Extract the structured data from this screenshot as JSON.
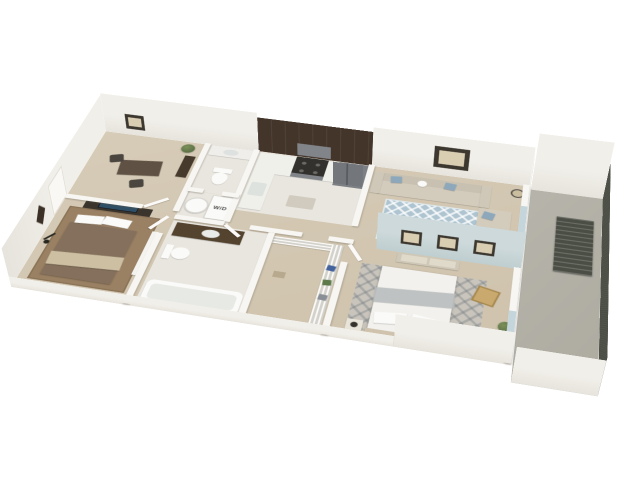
{
  "image": {
    "type": "3d-floorplan-render",
    "description": "Isometric 3D render of a two-bedroom, two-bathroom apartment floor plan with kitchen, living room, dining den, laundry closet, walk-in closet and a long side balcony"
  },
  "labels": {
    "washer_dryer": "W/D"
  },
  "colors": {
    "background": "#ffffff",
    "wall_face": "#f1efe9",
    "wall_top": "#f7f6f2",
    "accent_wall": "#cdd9da",
    "floor_carpet": "#d7ccb8",
    "floor_tile": "#e9e6df",
    "balcony_floor": "#b7b5ab",
    "railing": "#4b4e45",
    "cabinet_wood": "#43352a",
    "counter": "#eff0ea",
    "stainless": "#81858a",
    "sofa": "#d3ccbd",
    "pillow_blue": "#8da8bb",
    "rug_blue": "#aec4d0",
    "rug_gray": "#c9c5bd",
    "bed_white": "#f2f1ed",
    "bed_brown": "#84705c",
    "wood_light": "#d9cbb0",
    "table_wood": "#6b5949",
    "plant_green": "#5e7247",
    "frame_dark": "#3c372f",
    "tv_screen": "#2f4f66",
    "fixture_white": "#fafaf8",
    "glass": "#bdd2d9"
  },
  "rooms": [
    {
      "id": "dining-den",
      "name": "Dining / Den",
      "furniture": [
        "desk",
        "two chairs",
        "potted plant",
        "bookshelf",
        "wall art"
      ]
    },
    {
      "id": "kitchen",
      "name": "Kitchen",
      "furniture": [
        "upper cabinets",
        "L-counter",
        "range",
        "range hood",
        "refrigerator",
        "sink"
      ]
    },
    {
      "id": "living-room",
      "name": "Living Room",
      "furniture": [
        "sectional sofa",
        "blue pillows",
        "patterned area rug",
        "coffee table",
        "floor lamp",
        "wall art",
        "sliding balcony door"
      ]
    },
    {
      "id": "bathroom-1",
      "name": "Bathroom 1",
      "furniture": [
        "sink counter",
        "toilet"
      ]
    },
    {
      "id": "laundry-closet",
      "name": "Laundry Closet",
      "label": "W/D",
      "furniture": [
        "stacked washer-dryer",
        "water heater"
      ]
    },
    {
      "id": "bedroom-2",
      "name": "Bedroom 2",
      "furniture": [
        "bed with brown bedding",
        "TV dresser",
        "telescope",
        "closet",
        "wall medallion",
        "area rug"
      ]
    },
    {
      "id": "bathroom-2",
      "name": "Bathroom 2",
      "furniture": [
        "wood vanity with sink",
        "toilet",
        "bathtub"
      ]
    },
    {
      "id": "walk-in-closet",
      "name": "Walk-in Closet",
      "furniture": [
        "wire shelving",
        "hanging clothes"
      ]
    },
    {
      "id": "master-bedroom",
      "name": "Master Bedroom",
      "furniture": [
        "white bed",
        "blue accent wall",
        "three wall frames",
        "settee",
        "nightstands with lamps",
        "desk with chair",
        "wooden chair",
        "area rug",
        "potted plant",
        "sliding balcony door"
      ]
    },
    {
      "id": "balcony",
      "name": "Balcony",
      "furniture": [
        "slatted bench",
        "dark metal railing",
        "potted plant"
      ]
    }
  ]
}
